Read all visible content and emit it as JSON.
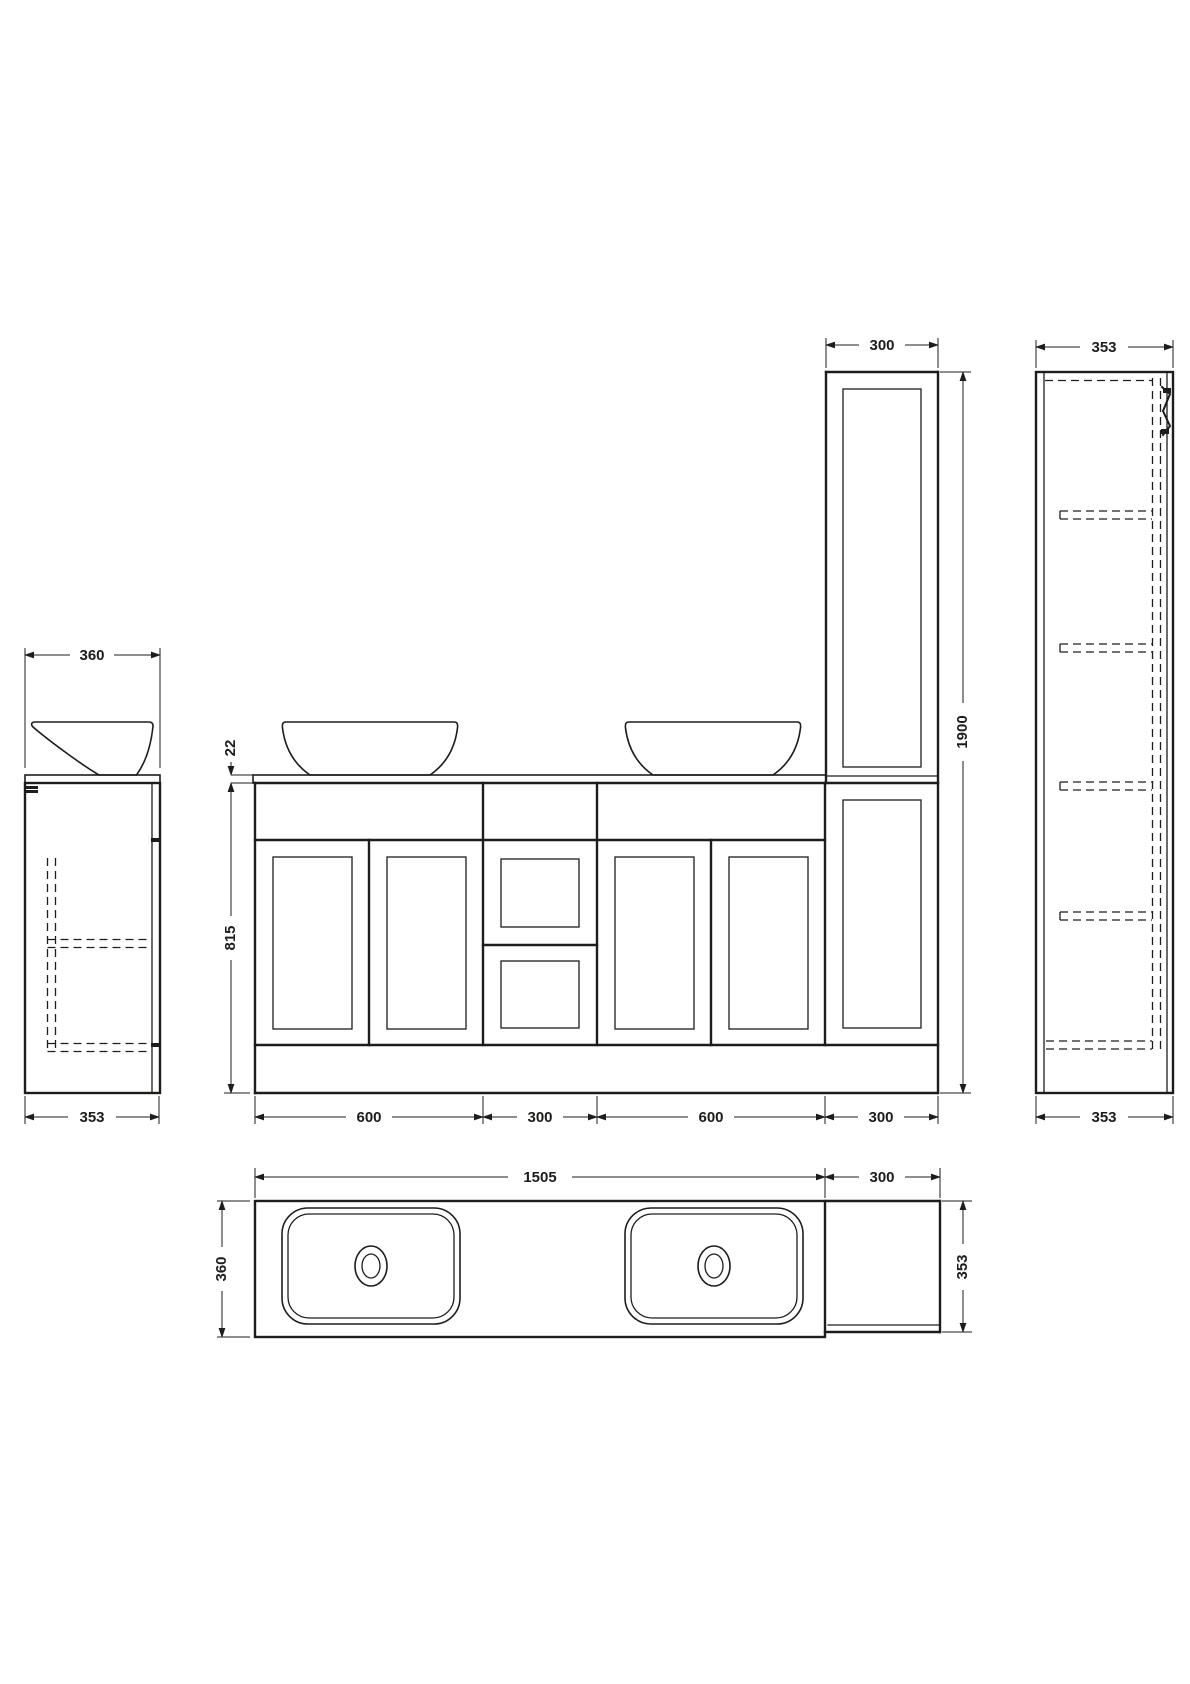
{
  "drawing": {
    "background": "#ffffff",
    "line_color": "#1d1d1b",
    "views": {
      "vanity_side": {
        "width_top": "360",
        "width_bottom": "353"
      },
      "front": {
        "counter_thickness": "22",
        "vanity_height": "815",
        "bottom_widths": {
          "w1": "600",
          "w2": "300",
          "w3": "600",
          "w4": "300"
        },
        "tall_unit_width": "300",
        "total_height": "1900"
      },
      "tall_side": {
        "width_top": "353",
        "width_bottom": "353"
      },
      "plan": {
        "counter_length": "1505",
        "tall_unit_width": "300",
        "counter_depth": "360",
        "tall_unit_depth": "353"
      }
    }
  }
}
